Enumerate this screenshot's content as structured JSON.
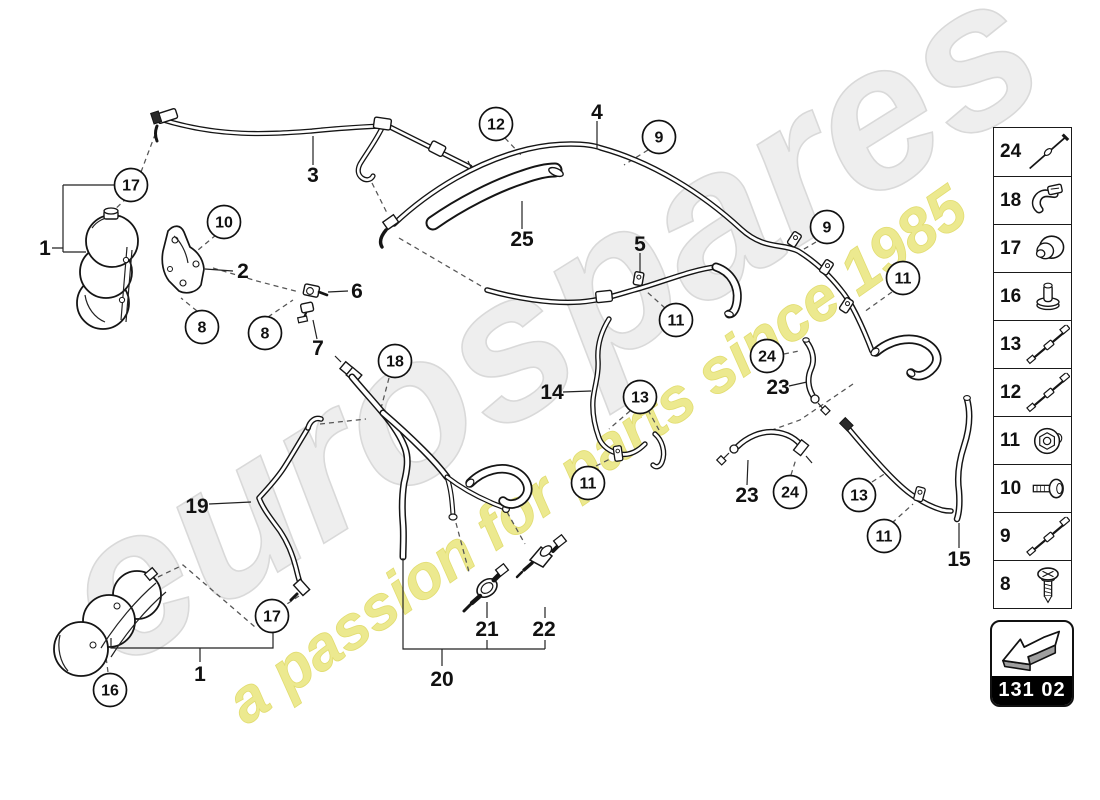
{
  "watermark": {
    "brand": "eurospares",
    "tagline": "a passion for parts since 1985",
    "brand_color": "#ececec",
    "tagline_color": "#ece98f"
  },
  "part_code": "131 02",
  "legend": {
    "items": [
      {
        "number": "24",
        "icon": "pin-icon"
      },
      {
        "number": "18",
        "icon": "clip-icon"
      },
      {
        "number": "17",
        "icon": "grommet-icon"
      },
      {
        "number": "16",
        "icon": "plug-icon"
      },
      {
        "number": "13",
        "icon": "cable-icon"
      },
      {
        "number": "12",
        "icon": "cable-icon"
      },
      {
        "number": "11",
        "icon": "nut-icon"
      },
      {
        "number": "10",
        "icon": "bolt-icon"
      },
      {
        "number": "9",
        "icon": "cable-icon"
      },
      {
        "number": "8",
        "icon": "screw-icon"
      }
    ]
  },
  "callouts": [
    {
      "n": "17",
      "x": 131,
      "y": 185
    },
    {
      "n": "10",
      "x": 224,
      "y": 222
    },
    {
      "n": "8",
      "x": 202,
      "y": 327
    },
    {
      "n": "8",
      "x": 265,
      "y": 333
    },
    {
      "n": "12",
      "x": 496,
      "y": 124
    },
    {
      "n": "9",
      "x": 659,
      "y": 137
    },
    {
      "n": "9",
      "x": 827,
      "y": 227
    },
    {
      "n": "11",
      "x": 903,
      "y": 278
    },
    {
      "n": "11",
      "x": 676,
      "y": 320
    },
    {
      "n": "18",
      "x": 395,
      "y": 361
    },
    {
      "n": "13",
      "x": 640,
      "y": 397
    },
    {
      "n": "24",
      "x": 767,
      "y": 356
    },
    {
      "n": "11",
      "x": 588,
      "y": 483
    },
    {
      "n": "24",
      "x": 790,
      "y": 492
    },
    {
      "n": "13",
      "x": 859,
      "y": 495
    },
    {
      "n": "11",
      "x": 884,
      "y": 536
    },
    {
      "n": "17",
      "x": 272,
      "y": 616
    },
    {
      "n": "16",
      "x": 110,
      "y": 690
    }
  ],
  "labels": [
    {
      "n": "1",
      "x": 45,
      "y": 248
    },
    {
      "n": "2",
      "x": 243,
      "y": 271
    },
    {
      "n": "3",
      "x": 313,
      "y": 175
    },
    {
      "n": "4",
      "x": 597,
      "y": 112
    },
    {
      "n": "5",
      "x": 640,
      "y": 244
    },
    {
      "n": "6",
      "x": 357,
      "y": 291
    },
    {
      "n": "7",
      "x": 318,
      "y": 348
    },
    {
      "n": "25",
      "x": 522,
      "y": 239
    },
    {
      "n": "14",
      "x": 552,
      "y": 392
    },
    {
      "n": "23",
      "x": 778,
      "y": 387
    },
    {
      "n": "19",
      "x": 197,
      "y": 506
    },
    {
      "n": "23",
      "x": 747,
      "y": 495
    },
    {
      "n": "15",
      "x": 959,
      "y": 559
    },
    {
      "n": "1",
      "x": 200,
      "y": 674
    },
    {
      "n": "20",
      "x": 442,
      "y": 679
    },
    {
      "n": "21",
      "x": 487,
      "y": 629
    },
    {
      "n": "22",
      "x": 544,
      "y": 629
    }
  ]
}
